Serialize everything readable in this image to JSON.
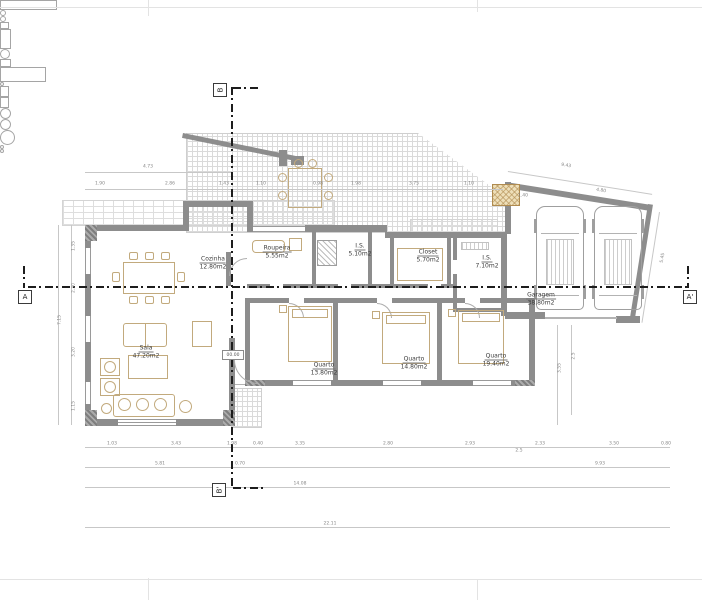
{
  "sheet": {
    "width": 702,
    "height": 600,
    "type": "architectural-floor-plan"
  },
  "colors": {
    "wall": "#8d8d8d",
    "line": "#b3b3b3",
    "furn": "#c2aa7d",
    "section": "#1d1d1d",
    "dimtext": "#878787"
  },
  "plan": {
    "level_marker": "00.00",
    "section_markers": [
      {
        "label": "A",
        "x": 18,
        "y": 290,
        "rot": 0
      },
      {
        "label": "A'",
        "x": 683,
        "y": 290,
        "rot": 0
      },
      {
        "label": "B",
        "x": 213,
        "y": 83,
        "rot": -90
      },
      {
        "label": "B'",
        "x": 212,
        "y": 483,
        "rot": -90
      }
    ],
    "rooms": [
      {
        "name": "Cozinha",
        "area": "12.80m2",
        "x": 213,
        "y": 263
      },
      {
        "name": "Roupeira",
        "area": "5.55m2",
        "x": 277,
        "y": 252
      },
      {
        "name": "I.S.",
        "area": "5.10m2",
        "x": 360,
        "y": 250
      },
      {
        "name": "Closet",
        "area": "5.70m2",
        "x": 428,
        "y": 256
      },
      {
        "name": "I.S.",
        "area": "7.10m2",
        "x": 487,
        "y": 262
      },
      {
        "name": "Sala",
        "area": "47.20m2",
        "x": 146,
        "y": 352
      },
      {
        "name": "Quarto",
        "area": "13.80m2",
        "x": 324,
        "y": 369
      },
      {
        "name": "Quarto",
        "area": "14.80m2",
        "x": 414,
        "y": 363
      },
      {
        "name": "Quarto",
        "area": "19.40m2",
        "x": 496,
        "y": 360
      },
      {
        "name": "Garagem",
        "area": "38.80m2",
        "x": 541,
        "y": 299
      }
    ],
    "dimensions": [
      {
        "x": 148,
        "y": 167,
        "v": "4.73"
      },
      {
        "x": 566,
        "y": 166,
        "v": "9.43",
        "rot": 9
      },
      {
        "x": 100,
        "y": 184,
        "v": "1.90"
      },
      {
        "x": 170,
        "y": 184,
        "v": "2.86"
      },
      {
        "x": 224,
        "y": 184,
        "v": "1.43"
      },
      {
        "x": 261,
        "y": 184,
        "v": "1.10"
      },
      {
        "x": 318,
        "y": 184,
        "v": "0.98"
      },
      {
        "x": 356,
        "y": 184,
        "v": "1.98"
      },
      {
        "x": 414,
        "y": 184,
        "v": "3.75"
      },
      {
        "x": 469,
        "y": 184,
        "v": "1.10"
      },
      {
        "x": 523,
        "y": 196,
        "v": "1.40"
      },
      {
        "x": 601,
        "y": 191,
        "v": "4.80",
        "rot": 9
      },
      {
        "x": 60,
        "y": 320,
        "v": "7.15",
        "rot": -90
      },
      {
        "x": 74,
        "y": 246,
        "v": "1.35",
        "rot": -90
      },
      {
        "x": 74,
        "y": 288,
        "v": "2.30",
        "rot": -90
      },
      {
        "x": 74,
        "y": 352,
        "v": "3.20",
        "rot": -90
      },
      {
        "x": 74,
        "y": 406,
        "v": "1.15",
        "rot": -90
      },
      {
        "x": 663,
        "y": 258,
        "v": "5.45",
        "rot": -81
      },
      {
        "x": 560,
        "y": 368,
        "v": "3.55",
        "rot": -90
      },
      {
        "x": 574,
        "y": 356,
        "v": "2.5",
        "rot": -90
      },
      {
        "x": 112,
        "y": 444,
        "v": "1.03"
      },
      {
        "x": 176,
        "y": 444,
        "v": "3.43"
      },
      {
        "x": 232,
        "y": 444,
        "v": "1.98"
      },
      {
        "x": 258,
        "y": 444,
        "v": "0.40"
      },
      {
        "x": 300,
        "y": 444,
        "v": "3.35"
      },
      {
        "x": 388,
        "y": 444,
        "v": "2.80"
      },
      {
        "x": 470,
        "y": 444,
        "v": "2.93"
      },
      {
        "x": 540,
        "y": 444,
        "v": "2.33"
      },
      {
        "x": 614,
        "y": 444,
        "v": "3.50"
      },
      {
        "x": 666,
        "y": 444,
        "v": "0.80"
      },
      {
        "x": 160,
        "y": 464,
        "v": "5.81"
      },
      {
        "x": 240,
        "y": 464,
        "v": "0.70"
      },
      {
        "x": 519,
        "y": 451,
        "v": "2.5"
      },
      {
        "x": 600,
        "y": 464,
        "v": "9.93"
      },
      {
        "x": 300,
        "y": 484,
        "v": "14.08"
      },
      {
        "x": 330,
        "y": 524,
        "v": "22.11"
      }
    ]
  }
}
